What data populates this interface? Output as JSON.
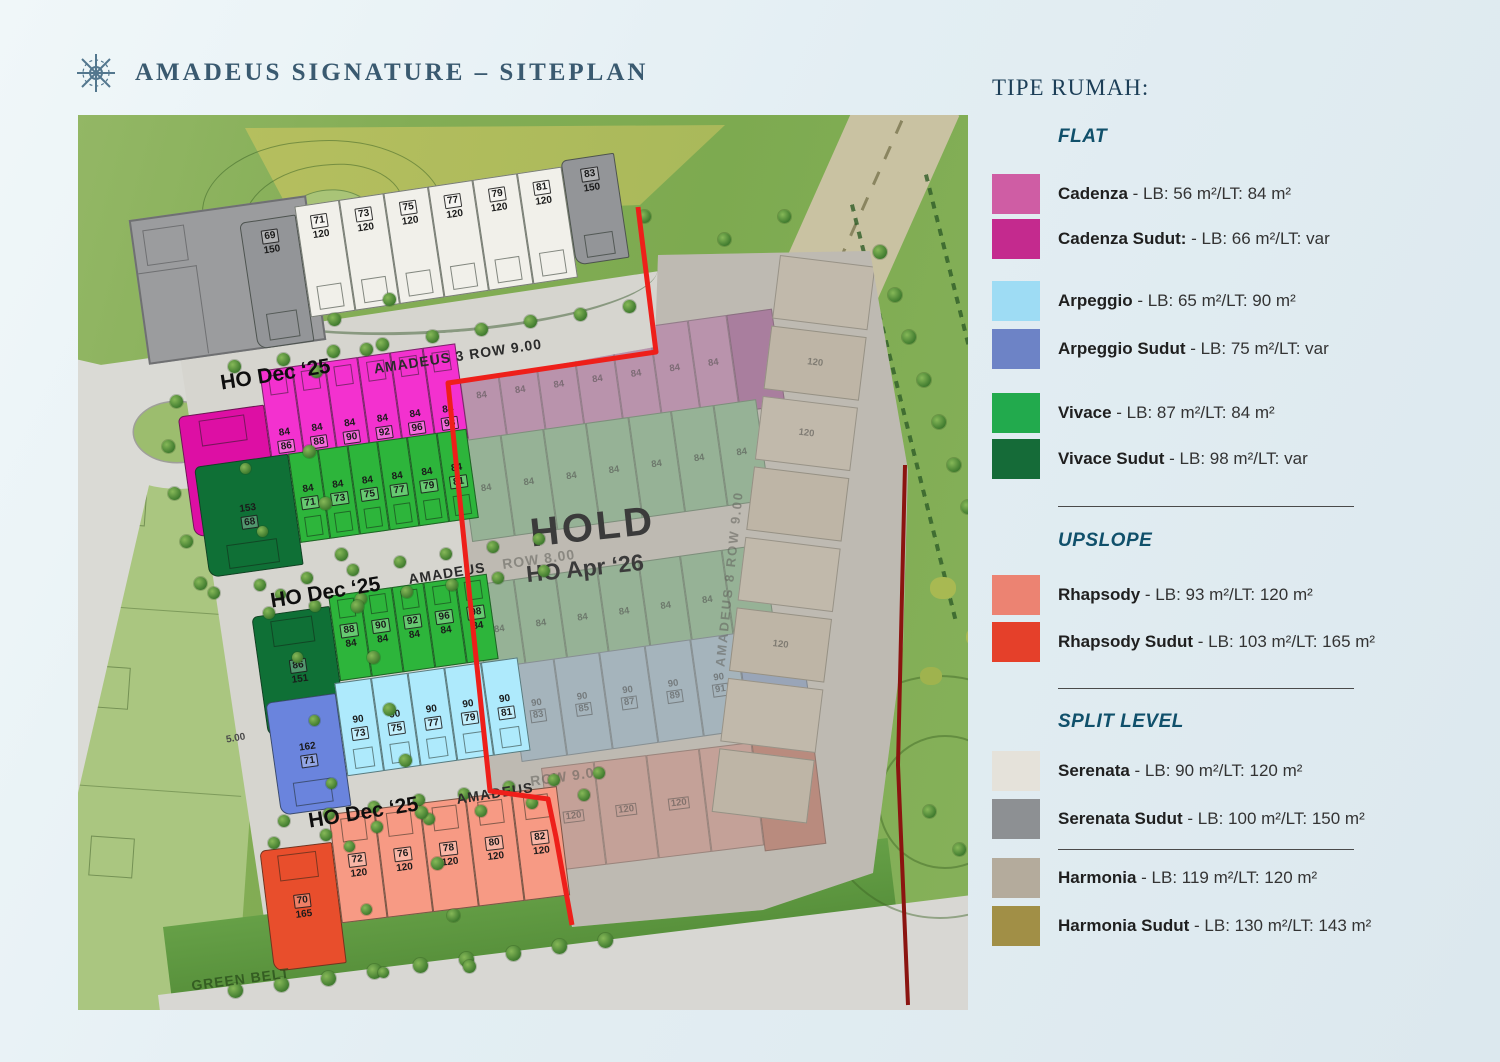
{
  "header": {
    "title": "AMADEUS SIGNATURE – SITEPLAN"
  },
  "legend": {
    "title": "TIPE RUMAH:",
    "sections": [
      {
        "label": "FLAT",
        "items": [
          {
            "name": "Cadenza",
            "desc": "LB: 56 m²/LT: 84 m²",
            "color": "#cf5da4"
          },
          {
            "name": "Cadenza Sudut:",
            "desc": "LB: 66 m²/LT: var",
            "color": "#c42a8e"
          },
          {
            "name": "Arpeggio",
            "desc": "LB: 65 m²/LT: 90 m²",
            "color": "#9edcf4"
          },
          {
            "name": "Arpeggio Sudut",
            "desc": "LB: 75 m²/LT: var",
            "color": "#6d83c6"
          },
          {
            "name": "Vivace",
            "desc": "LB: 87 m²/LT: 84 m²",
            "color": "#22aa4d"
          },
          {
            "name": "Vivace Sudut",
            "desc": "LB: 98 m²/LT: var",
            "color": "#156b38"
          }
        ]
      },
      {
        "label": "UPSLOPE",
        "items": [
          {
            "name": "Rhapsody",
            "desc": "LB: 93 m²/LT: 120 m²",
            "color": "#ec8372"
          },
          {
            "name": "Rhapsody Sudut",
            "desc": "LB: 103 m²/LT: 165 m²",
            "color": "#e5402a"
          }
        ]
      },
      {
        "label": "SPLIT LEVEL",
        "items": [
          {
            "name": "Serenata",
            "desc": "LB: 90 m²/LT: 120 m²",
            "color": "#e5e2da"
          },
          {
            "name": "Serenata Sudut",
            "desc": "LB: 100 m²/LT: 150 m²",
            "color": "#8d9093"
          },
          {
            "name": "Harmonia",
            "desc": "LB: 119 m²/LT: 120 m²",
            "color": "#b4ab9c"
          },
          {
            "name": "Harmonia Sudut",
            "desc": "LB: 130 m²/LT: 143 m²",
            "color": "#a18f46"
          }
        ]
      }
    ]
  },
  "map": {
    "hold": {
      "title": "HOLD",
      "subtitle": "HO Apr ‘26"
    },
    "labels": {
      "ho1": "HO Dec ‘25",
      "ho2": "HO Dec ‘25",
      "ho3": "HO Dec ‘25",
      "road_top": "AMADEUS 3 ROW 9.00",
      "road_mid": "AMADEUS",
      "road_mid_tail": "ROW 8.00",
      "road_low": "AMADEUS",
      "road_low_tail": "ROW 9.00",
      "road_vert": "AMADEUS 8 ROW 9.00",
      "green_belt": "GREEN BELT",
      "dim": "5.00"
    },
    "colors": {
      "boundary_red": "#ee1f1a",
      "boundary_dark_red": "#8b1410",
      "serenata": "#f1f0ea",
      "serenata_sudut": "#939598",
      "cadenza": "#f331cf",
      "cadenza_sudut": "#dd0fa4",
      "vivace": "#2db53b",
      "vivace_sudut": "#0f7036",
      "arpeggio": "#aeeafc",
      "arpeggio_sudut": "#6a84dd",
      "rhapsody": "#f79a84",
      "rhapsody_sudut": "#e84e2c"
    },
    "rows": {
      "serenata": {
        "fill": "serenata",
        "corner_fill": "serenata_sudut",
        "face": "bottom",
        "numpos": "top",
        "units": [
          {
            "t": "69",
            "b": "150",
            "box": "t",
            "c": true
          },
          {
            "t": "71",
            "b": "120",
            "box": "t"
          },
          {
            "t": "73",
            "b": "120",
            "box": "t"
          },
          {
            "t": "75",
            "b": "120",
            "box": "t"
          },
          {
            "t": "77",
            "b": "120",
            "box": "t"
          },
          {
            "t": "79",
            "b": "120",
            "box": "t"
          },
          {
            "t": "81",
            "b": "120",
            "box": "t"
          },
          {
            "t": "83",
            "b": "150",
            "box": "t",
            "c": true,
            "cend": true
          }
        ]
      },
      "cadenza": {
        "fill": "cadenza",
        "corner_fill": "cadenza_sudut",
        "face": "top",
        "numpos": "bottom",
        "units": [
          {
            "t": "153",
            "b": "82",
            "box": "b",
            "c": true
          },
          {
            "t": "84",
            "b": "86",
            "box": "b"
          },
          {
            "t": "84",
            "b": "88",
            "box": "b"
          },
          {
            "t": "84",
            "b": "90",
            "box": "b"
          },
          {
            "t": "84",
            "b": "92",
            "box": "b"
          },
          {
            "t": "84",
            "b": "96",
            "box": "b"
          },
          {
            "t": "84",
            "b": "98",
            "box": "b"
          }
        ]
      },
      "vivace_a": {
        "fill": "vivace",
        "corner_fill": "vivace_sudut",
        "face": "bottom",
        "numpos": "mid",
        "units": [
          {
            "t": "153",
            "b": "68",
            "box": "b",
            "c": true
          },
          {
            "t": "84",
            "b": "71",
            "box": "b"
          },
          {
            "t": "84",
            "b": "73",
            "box": "b"
          },
          {
            "t": "84",
            "b": "75",
            "box": "b"
          },
          {
            "t": "84",
            "b": "77",
            "box": "b"
          },
          {
            "t": "84",
            "b": "79",
            "box": "b"
          },
          {
            "t": "84",
            "b": "81",
            "box": "b"
          }
        ]
      },
      "vivace_b": {
        "fill": "vivace",
        "corner_fill": "vivace_sudut",
        "face": "top",
        "numpos": "mid",
        "units": [
          {
            "t": "86",
            "b": "151",
            "box": "t",
            "c": true
          },
          {
            "t": "88",
            "b": "84",
            "box": "t"
          },
          {
            "t": "90",
            "b": "84",
            "box": "t"
          },
          {
            "t": "92",
            "b": "84",
            "box": "t"
          },
          {
            "t": "96",
            "b": "84",
            "box": "t"
          },
          {
            "t": "98",
            "b": "84",
            "box": "t"
          }
        ]
      },
      "arpeggio": {
        "fill": "arpeggio",
        "corner_fill": "arpeggio_sudut",
        "face": "bottom",
        "numpos": "mid",
        "units": [
          {
            "t": "162",
            "b": "71",
            "box": "b",
            "c": true
          },
          {
            "t": "90",
            "b": "73",
            "box": "b"
          },
          {
            "t": "90",
            "b": "75",
            "box": "b"
          },
          {
            "t": "90",
            "b": "77",
            "box": "b"
          },
          {
            "t": "90",
            "b": "79",
            "box": "b"
          },
          {
            "t": "90",
            "b": "81",
            "box": "b"
          }
        ]
      },
      "rhapsody": {
        "fill": "rhapsody",
        "corner_fill": "rhapsody_sudut",
        "face": "top",
        "numpos": "mid",
        "units": [
          {
            "t": "70",
            "b": "165",
            "box": "t",
            "c": true
          },
          {
            "t": "72",
            "b": "120",
            "box": "t"
          },
          {
            "t": "76",
            "b": "120",
            "box": "t"
          },
          {
            "t": "78",
            "b": "120",
            "box": "t"
          },
          {
            "t": "80",
            "b": "120",
            "box": "t"
          },
          {
            "t": "82",
            "b": "120",
            "box": "t"
          }
        ]
      }
    },
    "muted_rows": {
      "pink": {
        "fill": "#bf8db2",
        "corner": "#aa6f9e",
        "units": [
          {
            "t": "84"
          },
          {
            "t": "84"
          },
          {
            "t": "84"
          },
          {
            "t": "84"
          },
          {
            "t": "84"
          },
          {
            "t": "84"
          },
          {
            "t": "84"
          },
          {
            "c": true
          }
        ]
      },
      "green_a": {
        "fill": "#8fb794",
        "units": [
          {
            "t": "84"
          },
          {
            "t": "84"
          },
          {
            "t": "84"
          },
          {
            "t": "84"
          },
          {
            "t": "84"
          },
          {
            "t": "84"
          },
          {
            "t": "84"
          }
        ]
      },
      "green_b": {
        "fill": "#8fb794",
        "units": [
          {
            "t": "84"
          },
          {
            "t": "84"
          },
          {
            "t": "84"
          },
          {
            "t": "84"
          },
          {
            "t": "84"
          },
          {
            "t": "84"
          },
          {
            "t": "84"
          }
        ]
      },
      "blue": {
        "fill": "#a4bac8",
        "corner": "#93a5c2",
        "units": [
          {
            "t": "90",
            "b": "83"
          },
          {
            "t": "90",
            "b": "85"
          },
          {
            "t": "90",
            "b": "87"
          },
          {
            "t": "90",
            "b": "89"
          },
          {
            "t": "90",
            "b": "91"
          },
          {
            "c": true
          }
        ]
      },
      "salmon": {
        "fill": "#cfa096",
        "corner": "#bf8172",
        "units": [
          {
            "b": "120"
          },
          {
            "b": "120"
          },
          {
            "b": "120"
          },
          {
            "b": "120"
          },
          {
            "c": true
          }
        ]
      },
      "beige": {
        "fill": "#cbc1b0",
        "blocks": [
          "",
          "120",
          "120",
          "",
          "",
          "120",
          "",
          ""
        ]
      }
    }
  }
}
